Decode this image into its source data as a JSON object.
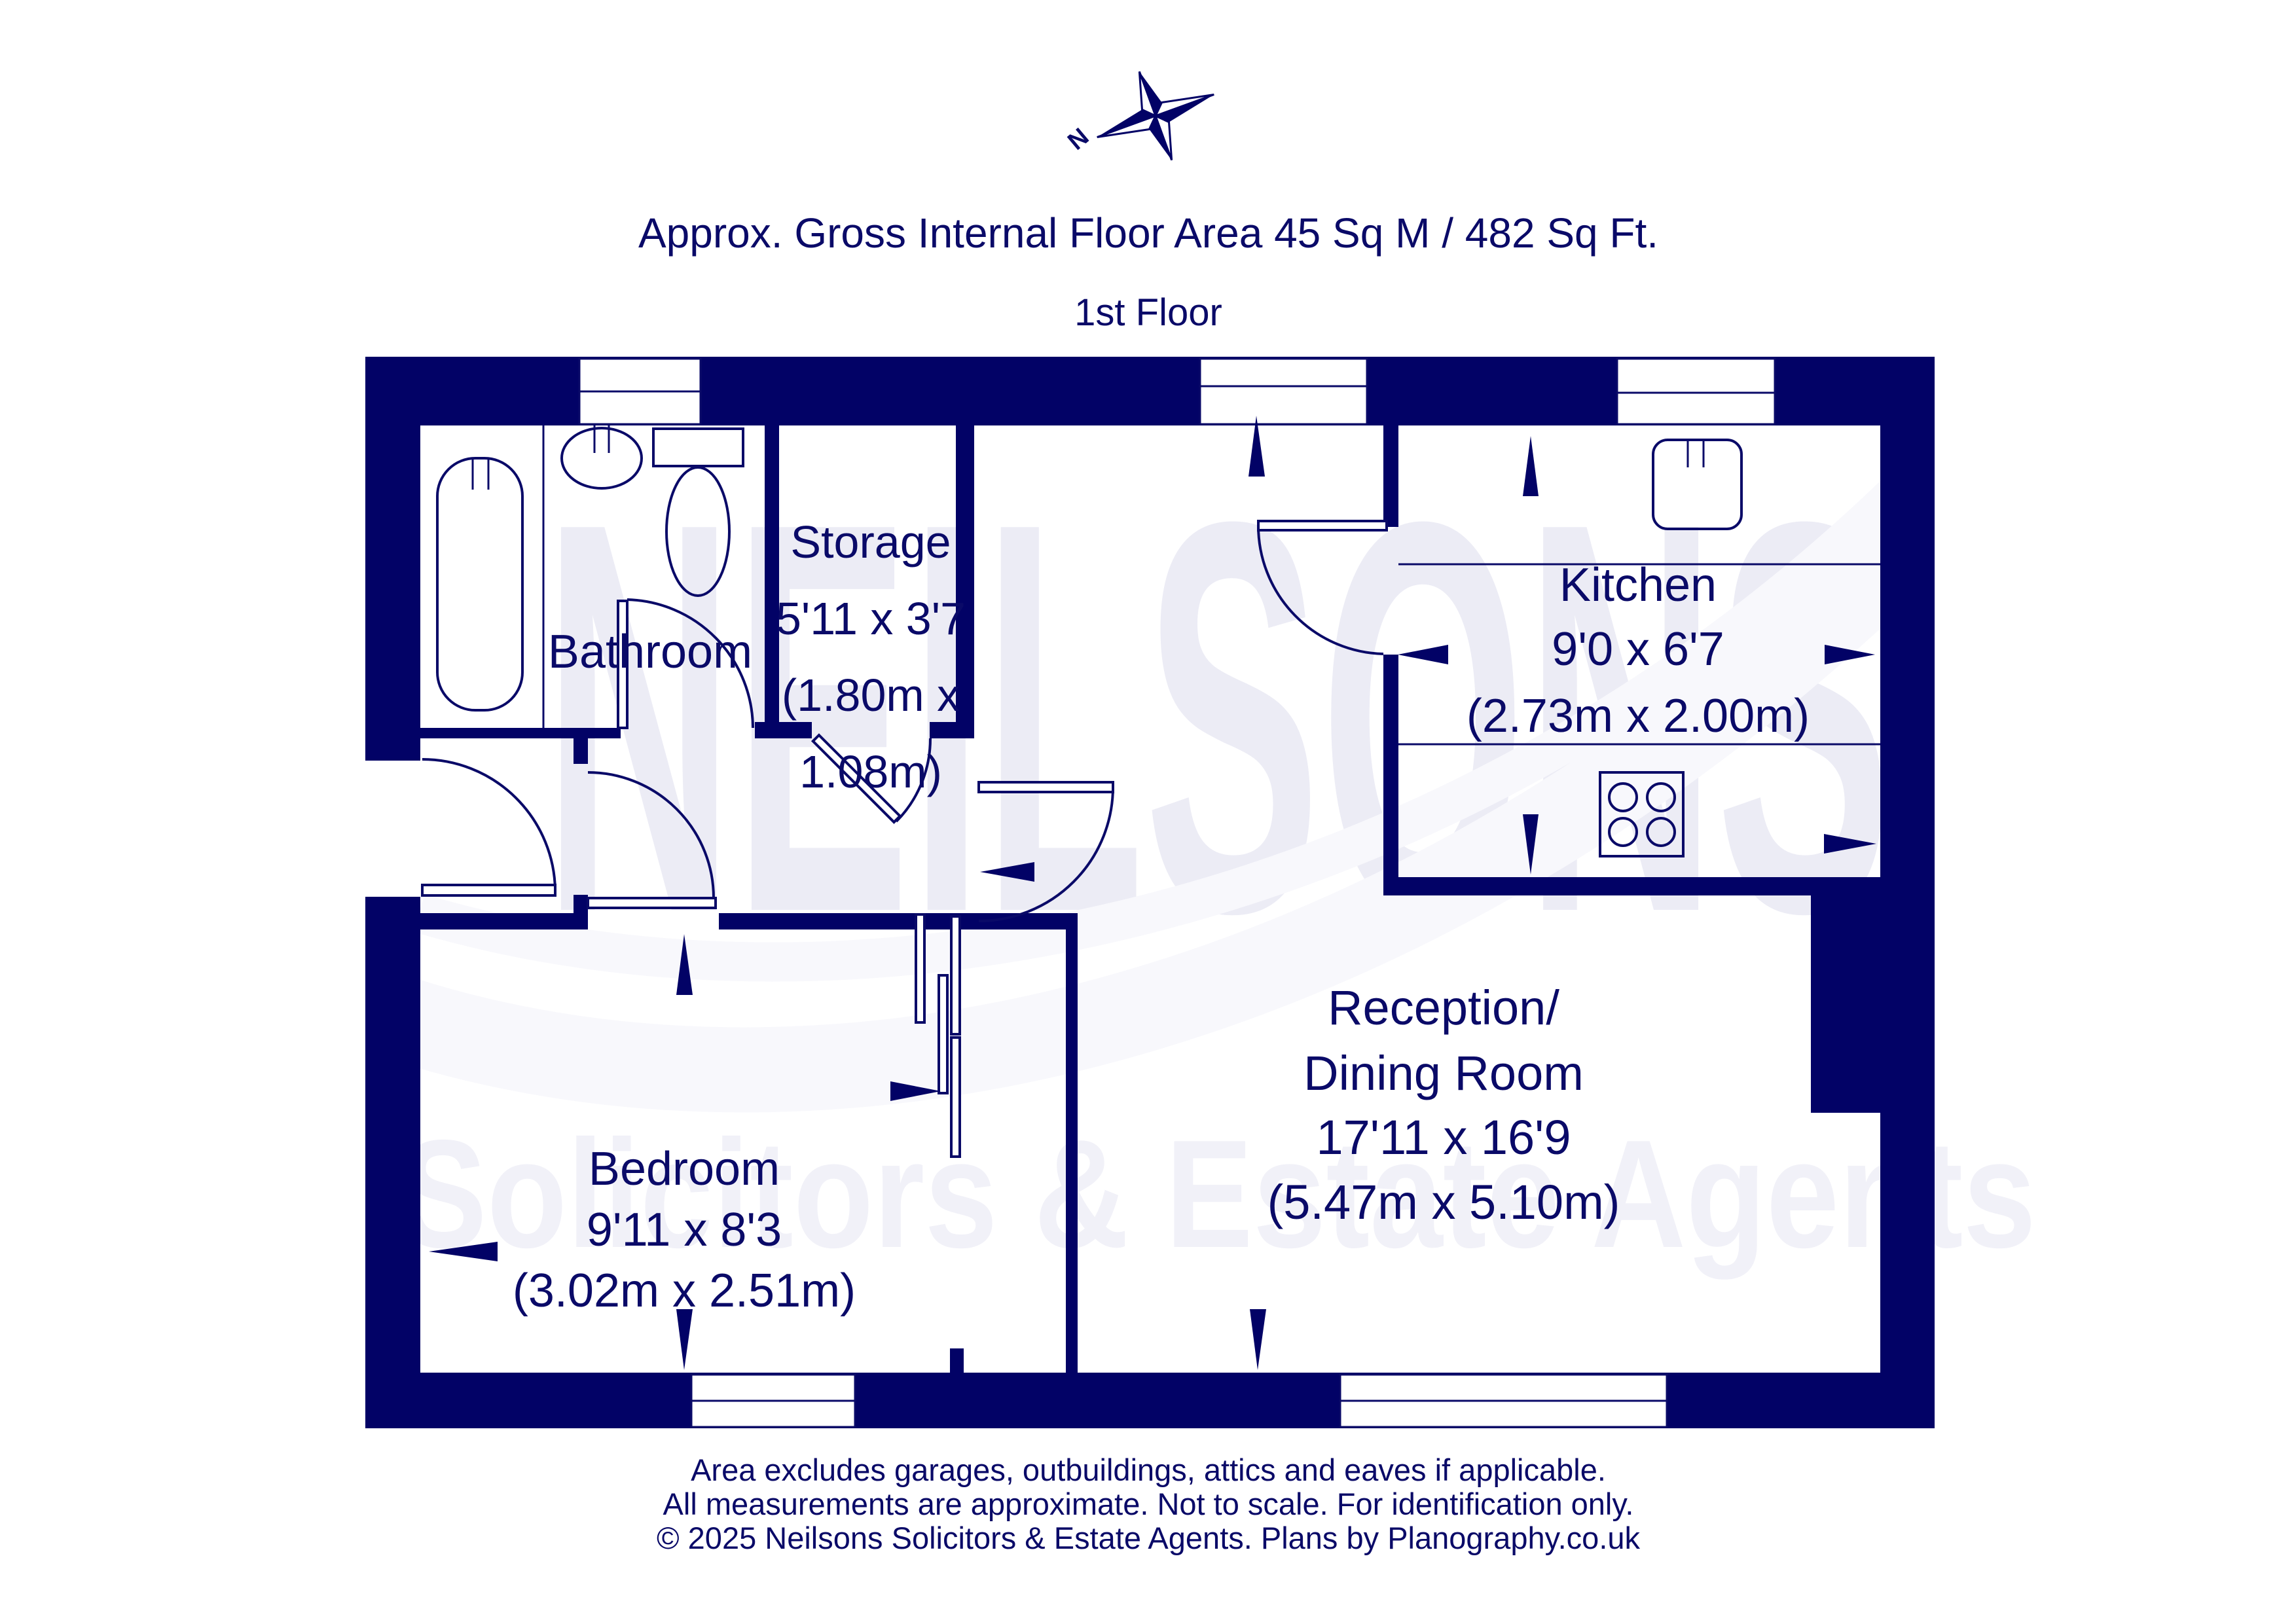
{
  "meta": {
    "colors": {
      "wall_navy": "#020266",
      "text_navy": "#0a0a68",
      "watermark_gray": "#ececf5",
      "background": "#ffffff"
    }
  },
  "header": {
    "area_line": "Approx. Gross Internal Floor Area 45 Sq M / 482 Sq Ft.",
    "floor_label": "1st Floor"
  },
  "compass": {
    "north_label": "N"
  },
  "watermark": {
    "brand": "NEILSONS",
    "tagline": "Solicitors & Estate Agents"
  },
  "rooms": {
    "bathroom": {
      "name": "Bathroom"
    },
    "storage": {
      "name": "Storage",
      "dims_imperial": "5'11 x 3'7",
      "dims_metric_1": "(1.80m x",
      "dims_metric_2": "1.08m)"
    },
    "kitchen": {
      "name": "Kitchen",
      "dims_imperial": "9'0 x 6'7",
      "dims_metric": "(2.73m x 2.00m)"
    },
    "reception": {
      "name_1": "Reception/",
      "name_2": "Dining Room",
      "dims_imperial": "17'11 x 16'9",
      "dims_metric": "(5.47m x 5.10m)"
    },
    "bedroom": {
      "name": "Bedroom",
      "dims_imperial": "9'11 x 8'3",
      "dims_metric": "(3.02m x 2.51m)"
    }
  },
  "footer": {
    "line1": "Area excludes garages, outbuildings, attics and eaves if applicable.",
    "line2": "All measurements are approximate. Not to scale. For identification only.",
    "line3": "© 2025 Neilsons Solicitors & Estate Agents. Plans by Planography.co.uk"
  },
  "icons": {
    "compass-rose-icon": "four-point star, navy/white facets",
    "bathtub": "rounded rectangle with taps",
    "wash-basin": "ellipse with taps",
    "toilet": "cistern rectangle + bowl ellipse",
    "kitchen-sink": "rounded square with taps",
    "hob": "square with four burner circles",
    "dimension-arrow": "thin elongated navy triangle",
    "window": "white rectangle with mullion line",
    "door": "white leaf rectangle + quarter-circle swing arc"
  }
}
